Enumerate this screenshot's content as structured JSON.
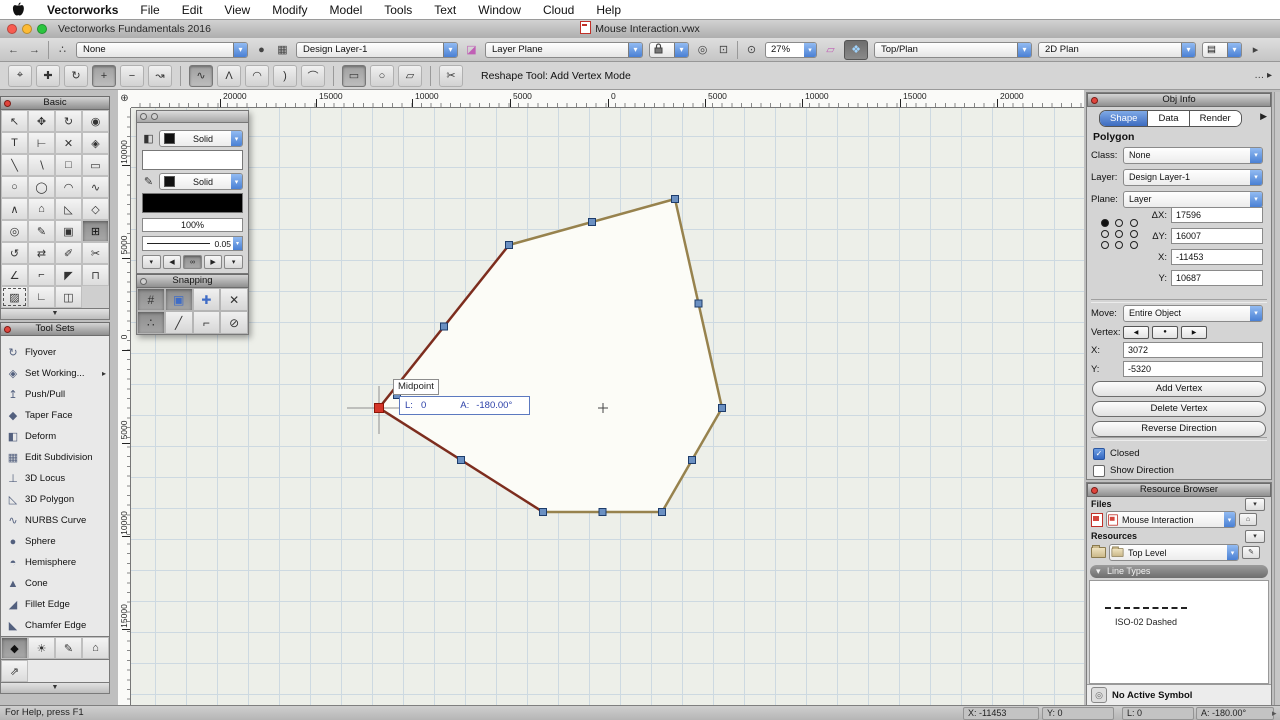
{
  "menu_bar": {
    "items": [
      "Vectorworks",
      "File",
      "Edit",
      "View",
      "Modify",
      "Model",
      "Tools",
      "Text",
      "Window",
      "Cloud",
      "Help"
    ]
  },
  "title_bar": {
    "app_title": "Vectorworks Fundamentals 2016",
    "doc_title": "Mouse Interaction.vwx"
  },
  "toolbar": {
    "back_icon": "←",
    "forward_icon": "→",
    "nav_icon": "∴",
    "tool_dropdown": "None",
    "sphere_icon": "●",
    "layers_icon": "▦",
    "layer_dropdown": "Design Layer-1",
    "plane_icon": "◪",
    "plane_dropdown": "Layer Plane",
    "doczoom_icon": "◎",
    "flag_icon": "⊡",
    "mag_icon": "⊙",
    "zoom_value": "27%",
    "wplane_icon": "▱",
    "unified_icon": "❖",
    "view_dropdown": "Top/Plan",
    "render_dropdown": "2D Plan",
    "views_icon": "▤",
    "overflow_icon": "▸",
    "chevron": "▾"
  },
  "mode_bar": {
    "label": "Reshape Tool: Add Vertex Mode",
    "overflow": "… ▸",
    "buttons": [
      {
        "name": "mode-move-vertex",
        "glyph": "⌖"
      },
      {
        "name": "mode-move-handle",
        "glyph": "✚"
      },
      {
        "name": "mode-change-vertex",
        "glyph": "↻"
      },
      {
        "name": "mode-add-vertex",
        "glyph": "+",
        "pressed": true
      },
      {
        "name": "mode-delete-vertex",
        "glyph": "−"
      },
      {
        "name": "mode-hide-edge",
        "glyph": "↝"
      },
      {
        "sep": true
      },
      {
        "name": "mode-vertex-polyline",
        "glyph": "∿",
        "pressed": true
      },
      {
        "name": "mode-vertex-corner",
        "glyph": "Λ"
      },
      {
        "name": "mode-vertex-bezier",
        "glyph": "◠"
      },
      {
        "name": "mode-vertex-cubic",
        "glyph": ")"
      },
      {
        "name": "mode-vertex-tangent",
        "glyph": "⌒"
      },
      {
        "sep": true
      },
      {
        "name": "mode-marquee-rect",
        "glyph": "▭",
        "pressed": true
      },
      {
        "name": "mode-marquee-lasso",
        "glyph": "○"
      },
      {
        "name": "mode-marquee-polygon",
        "glyph": "▱"
      },
      {
        "sep": true
      },
      {
        "name": "mode-hidden-line-options",
        "glyph": "✂"
      }
    ]
  },
  "rulers": {
    "origin_icon": "⊕",
    "horizontal": [
      {
        "x": 89,
        "label": "20000"
      },
      {
        "x": 185,
        "label": "15000"
      },
      {
        "x": 281,
        "label": "10000"
      },
      {
        "x": 379,
        "label": "5000"
      },
      {
        "x": 477,
        "label": "0"
      },
      {
        "x": 574,
        "label": "5000"
      },
      {
        "x": 671,
        "label": "10000"
      },
      {
        "x": 769,
        "label": "15000"
      },
      {
        "x": 866,
        "label": "20000"
      }
    ],
    "vertical": [
      {
        "y": 57,
        "label": "10000"
      },
      {
        "y": 150,
        "label": "5000"
      },
      {
        "y": 242,
        "label": "0"
      },
      {
        "y": 335,
        "label": "5000"
      },
      {
        "y": 428,
        "label": "10000"
      },
      {
        "y": 521,
        "label": "15000"
      }
    ]
  },
  "basic_palette": {
    "title": "Basic",
    "tools": [
      {
        "name": "tool-selection",
        "glyph": "↖"
      },
      {
        "name": "tool-pan",
        "glyph": "✥"
      },
      {
        "name": "tool-flyover",
        "glyph": "↻"
      },
      {
        "name": "tool-zoom",
        "glyph": "◉"
      },
      {
        "name": "tool-text",
        "glyph": "T"
      },
      {
        "name": "tool-dimension",
        "glyph": "⊢"
      },
      {
        "name": "tool-delete",
        "glyph": "✕"
      },
      {
        "name": "tool-3d-cube",
        "glyph": "◈"
      },
      {
        "name": "tool-line",
        "glyph": "╲"
      },
      {
        "name": "tool-double-line",
        "glyph": "∖"
      },
      {
        "name": "tool-rectangle",
        "glyph": "□"
      },
      {
        "name": "tool-rounded-rectangle",
        "glyph": "▭"
      },
      {
        "name": "tool-circle",
        "glyph": "○"
      },
      {
        "name": "tool-oval",
        "glyph": "◯"
      },
      {
        "name": "tool-arc",
        "glyph": "◠"
      },
      {
        "name": "tool-freehand",
        "glyph": "∿"
      },
      {
        "name": "tool-polyline",
        "glyph": "∧"
      },
      {
        "name": "tool-polygon",
        "glyph": "⌂"
      },
      {
        "name": "tool-3d-polygon",
        "glyph": "◺"
      },
      {
        "name": "tool-regular-polygon",
        "glyph": "◇"
      },
      {
        "name": "tool-spiral",
        "glyph": "◎"
      },
      {
        "name": "tool-eyedropper",
        "glyph": "✎"
      },
      {
        "name": "tool-clip",
        "glyph": "▣"
      },
      {
        "name": "tool-reshape",
        "glyph": "⊞",
        "selected": true
      },
      {
        "name": "tool-rotate",
        "glyph": "↺"
      },
      {
        "name": "tool-mirror",
        "glyph": "⇄"
      },
      {
        "name": "tool-attribute-brush",
        "glyph": "✐"
      },
      {
        "name": "tool-trim",
        "glyph": "✂"
      },
      {
        "name": "tool-shear",
        "glyph": "∠"
      },
      {
        "name": "tool-fillet",
        "glyph": "⌐"
      },
      {
        "name": "tool-chamfer",
        "glyph": "◤"
      },
      {
        "name": "tool-connect-combine",
        "glyph": "⊓"
      },
      {
        "name": "tool-eraser",
        "glyph": "▨",
        "marquee": true
      },
      {
        "name": "tool-move-by-points",
        "glyph": "∟"
      },
      {
        "name": "tool-symbol-insert",
        "glyph": "◫"
      }
    ],
    "more_icon": "▼"
  },
  "tool_sets": {
    "title": "Tool Sets",
    "items": [
      {
        "name": "toolset-flyover",
        "glyph": "↻",
        "label": "Flyover"
      },
      {
        "name": "toolset-set-working-plane",
        "glyph": "◈",
        "label": "Set Working...",
        "submenu": true
      },
      {
        "name": "toolset-push-pull",
        "glyph": "↥",
        "label": "Push/Pull"
      },
      {
        "name": "toolset-taper-face",
        "glyph": "◆",
        "label": "Taper Face"
      },
      {
        "name": "toolset-deform",
        "glyph": "◧",
        "label": "Deform"
      },
      {
        "name": "toolset-edit-subdivision",
        "glyph": "▦",
        "label": "Edit Subdivision"
      },
      {
        "name": "toolset-3d-locus",
        "glyph": "⊥",
        "label": "3D Locus"
      },
      {
        "name": "toolset-3d-polygon",
        "glyph": "◺",
        "label": "3D Polygon"
      },
      {
        "name": "toolset-nurbs-curve",
        "glyph": "∿",
        "label": "NURBS Curve"
      },
      {
        "name": "toolset-sphere",
        "glyph": "●",
        "label": "Sphere"
      },
      {
        "name": "toolset-hemisphere",
        "glyph": "◓",
        "label": "Hemisphere"
      },
      {
        "name": "toolset-cone",
        "glyph": "▲",
        "label": "Cone"
      },
      {
        "name": "toolset-fillet-edge",
        "glyph": "◢",
        "label": "Fillet Edge"
      },
      {
        "name": "toolset-chamfer-edge",
        "glyph": "◣",
        "label": "Chamfer Edge"
      }
    ],
    "tabs": [
      {
        "name": "toolset-tab-3d-modeling",
        "glyph": "◆",
        "selected": true
      },
      {
        "name": "toolset-tab-visualization",
        "glyph": "☀"
      },
      {
        "name": "toolset-tab-dims-notes",
        "glyph": "✎"
      },
      {
        "name": "toolset-tab-building-shell",
        "glyph": "⌂"
      },
      {
        "name": "toolset-tab-site-planning",
        "glyph": "⇗",
        "row2": true
      }
    ],
    "more_icon": "▼"
  },
  "attributes_palette": {
    "fill_icon": "◧",
    "pen_icon": "✎",
    "fill_style": "Solid",
    "pen_style": "Solid",
    "opacity": "100%",
    "line_weight": "0.05",
    "nav_buttons": [
      {
        "name": "attr-drop-left",
        "glyph": "▾"
      },
      {
        "name": "attr-prev",
        "glyph": "◀"
      },
      {
        "name": "attr-link",
        "glyph": "∞",
        "pressed": true
      },
      {
        "name": "attr-next",
        "glyph": "▶"
      },
      {
        "name": "attr-drop-right",
        "glyph": "▾"
      }
    ]
  },
  "snapping_palette": {
    "title": "Snapping",
    "buttons": [
      {
        "name": "snap-grid",
        "glyph": "#",
        "pressed": true
      },
      {
        "name": "snap-object",
        "glyph": "▣",
        "pressed": true,
        "blue": true
      },
      {
        "name": "snap-angle",
        "glyph": "✚",
        "blue": true
      },
      {
        "name": "snap-intersection",
        "glyph": "✕"
      },
      {
        "name": "snap-smart-points",
        "glyph": "∴",
        "pressed": true
      },
      {
        "name": "snap-distance",
        "glyph": "╱"
      },
      {
        "name": "snap-smart-edge",
        "glyph": "⌐"
      },
      {
        "name": "snap-tangent",
        "glyph": "⊘"
      }
    ]
  },
  "canvas": {
    "tooltip": "Midpoint",
    "databar": {
      "l_label": "L:",
      "l_value": "0",
      "a_label": "A:",
      "a_value": "-180.00°"
    },
    "polygon": {
      "fill": "#fcfcf7",
      "edge_color": "#97824d",
      "selected_edge_color": "#7d2d1e",
      "handle_fill": "#6b90c2",
      "handle_stroke": "#1d3c6b",
      "corners": [
        [
          544,
          91
        ],
        [
          378,
          137
        ],
        [
          248,
          300
        ],
        [
          412,
          404
        ],
        [
          531,
          404
        ],
        [
          591,
          300
        ]
      ],
      "red_vertex_index": 2,
      "red_edges": [
        1,
        2
      ],
      "red_vertex_fill": "#d5362a",
      "red_vertex_stroke": "#8c1508",
      "snap_point": [
        266,
        287
      ],
      "center_mark": [
        472,
        300
      ]
    }
  },
  "obj_info": {
    "title": "Obj Info",
    "tabs": [
      "Shape",
      "Data",
      "Render"
    ],
    "active_tab": "Shape",
    "tabs_overflow": "▶",
    "object_type": "Polygon",
    "class_label": "Class:",
    "class_value": "None",
    "layer_label": "Layer:",
    "layer_value": "Design Layer-1",
    "plane_label": "Plane:",
    "plane_value": "Layer",
    "fields": [
      {
        "label": "ΔX:",
        "value": "17596"
      },
      {
        "label": "ΔY:",
        "value": "16007"
      },
      {
        "label": "X:",
        "value": "-11453"
      },
      {
        "label": "Y:",
        "value": "10687"
      }
    ],
    "move_label": "Move:",
    "move_value": "Entire Object",
    "vertex_label": "Vertex:",
    "vertex_buttons": [
      {
        "name": "vertex-prev-button",
        "glyph": "◀"
      },
      {
        "name": "vertex-current-button",
        "glyph": "●"
      },
      {
        "name": "vertex-next-button",
        "glyph": "▶"
      }
    ],
    "vx_label": "X:",
    "vx_value": "3072",
    "vy_label": "Y:",
    "vy_value": "-5320",
    "buttons": [
      "Add Vertex",
      "Delete Vertex",
      "Reverse Direction"
    ],
    "checkboxes": [
      {
        "label": "Closed",
        "checked": true
      },
      {
        "label": "Show Direction",
        "checked": false
      }
    ]
  },
  "resource_browser": {
    "title": "Resource Browser",
    "files_label": "Files",
    "file_value": "Mouse Interaction",
    "resources_label": "Resources",
    "resource_value": "Top Level",
    "chevron_icon": "▾",
    "home_icon": "⌂",
    "tool_icon": "✎",
    "section_title": "Line Types",
    "section_arrow": "▾",
    "line_type_name": "ISO-02 Dashed",
    "footer": "No Active Symbol"
  },
  "status_bar": {
    "help": "For Help, press F1",
    "x": "X: -11453",
    "y": "Y: 0",
    "l": "L: 0",
    "a": "A: -180.00°",
    "arrow": "▸"
  }
}
